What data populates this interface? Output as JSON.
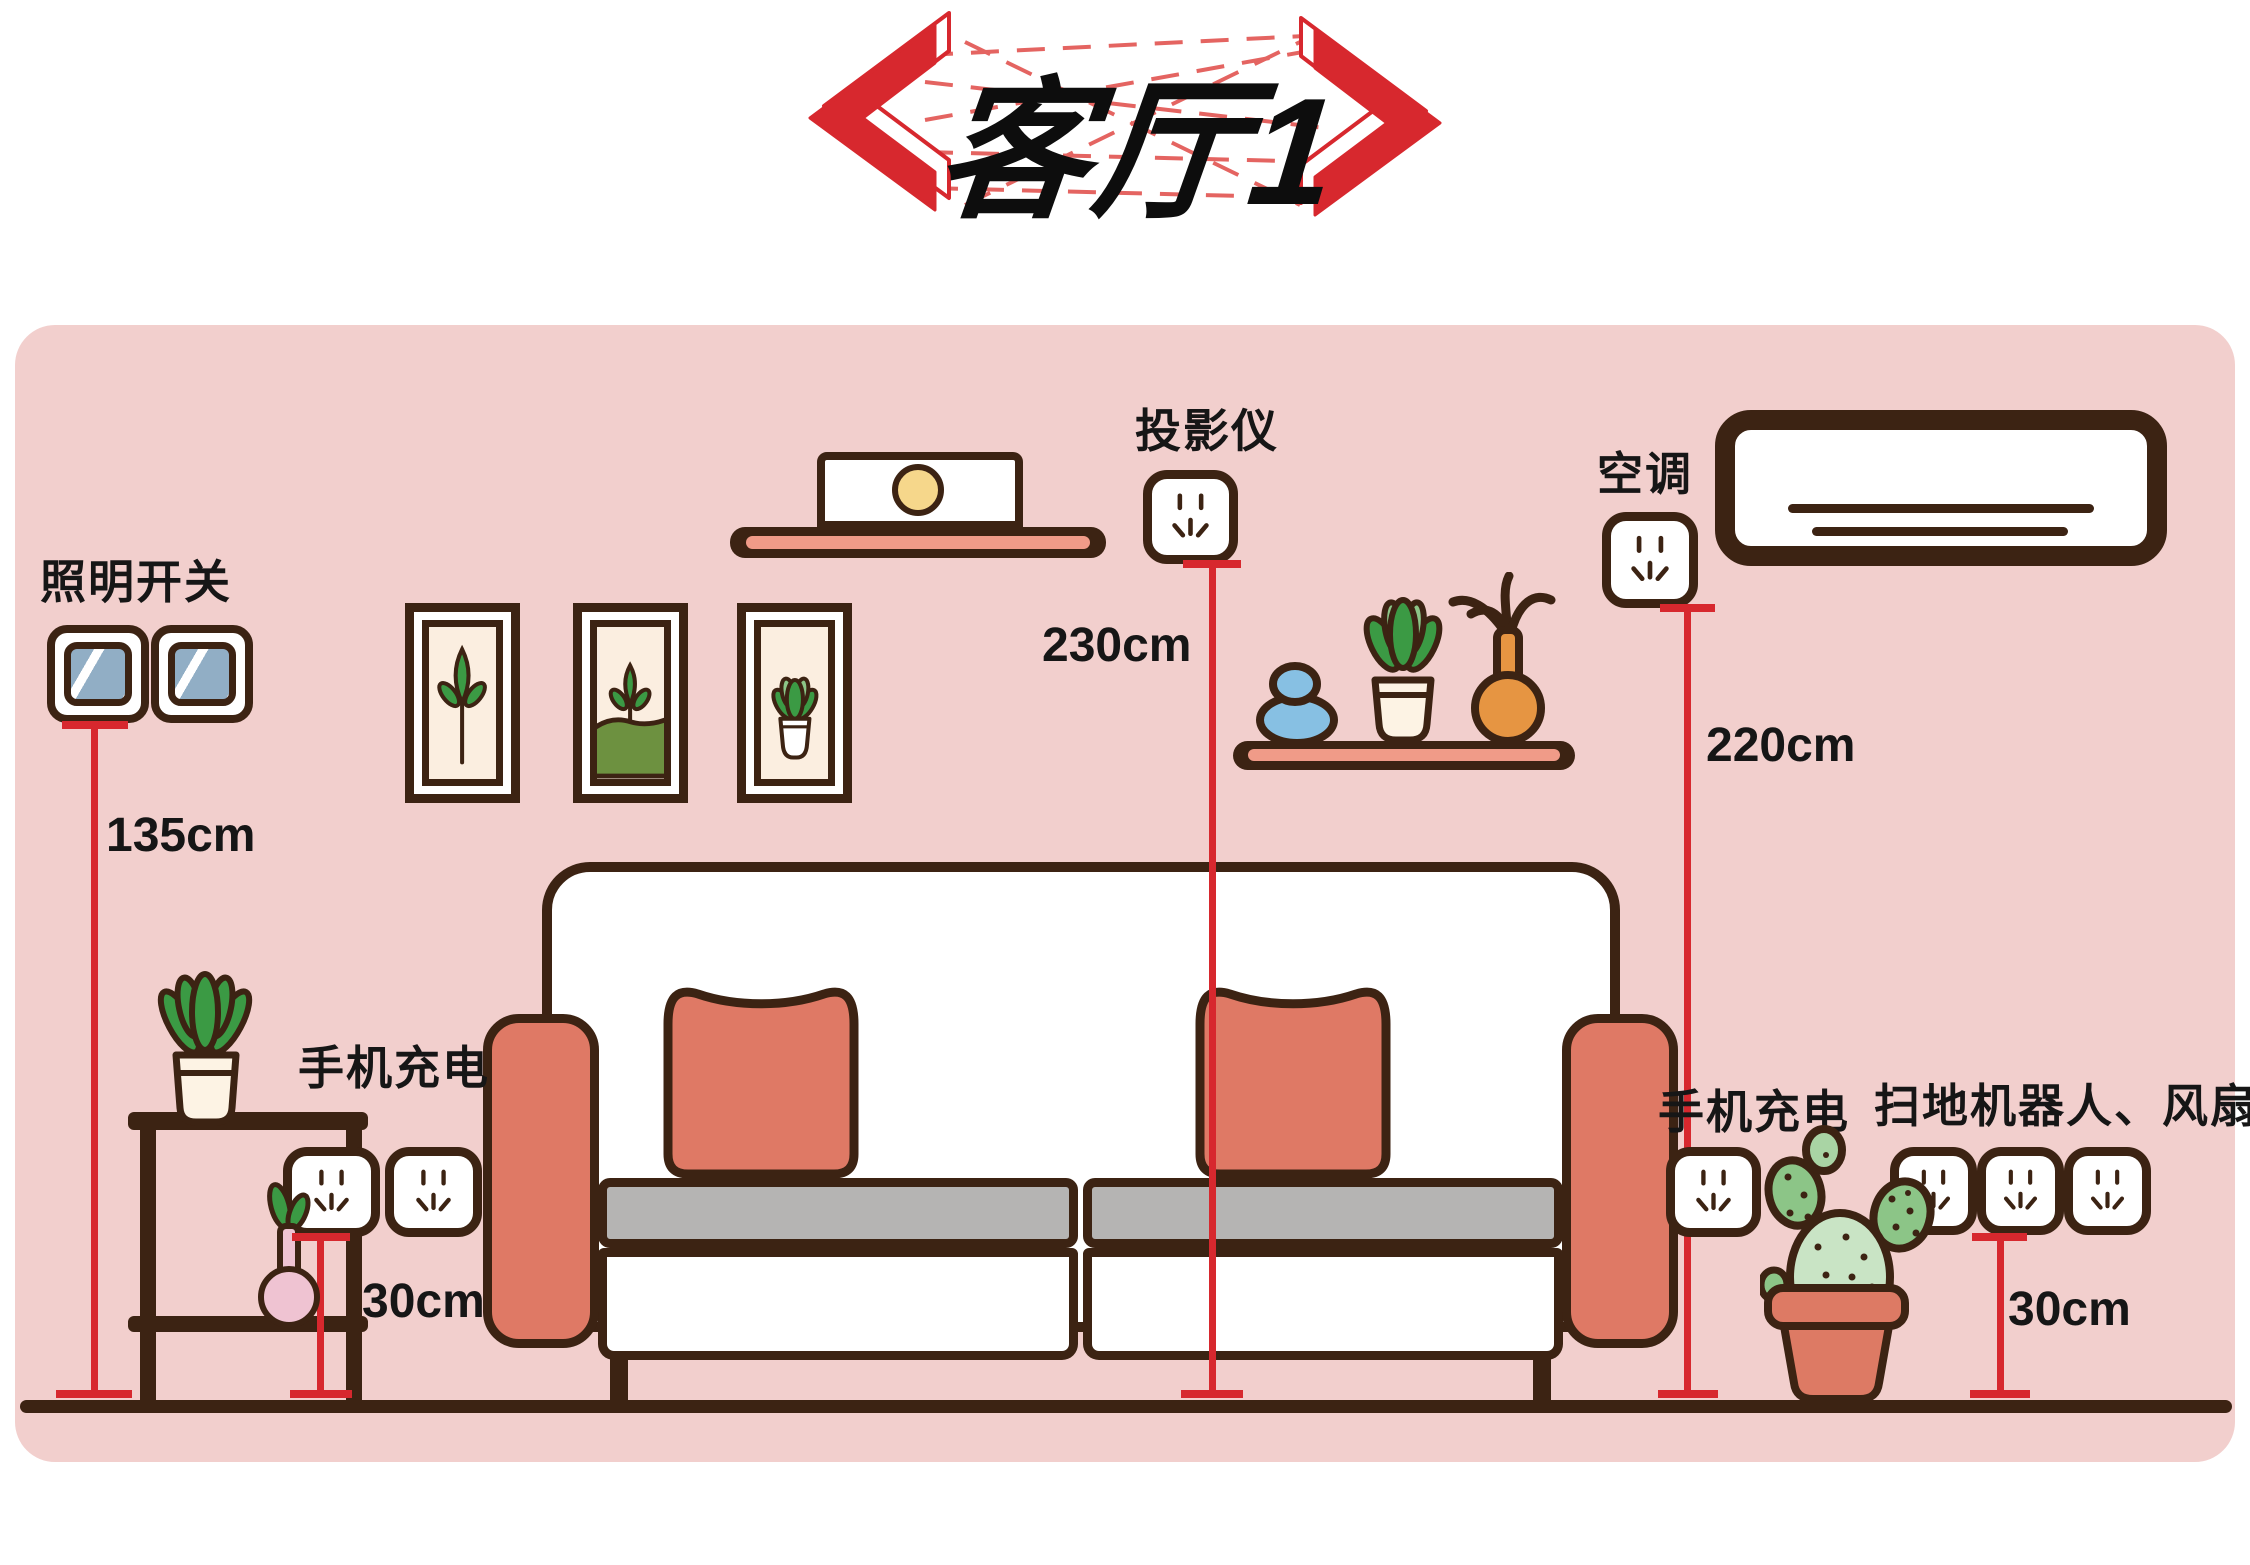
{
  "title": "客厅1",
  "scene": {
    "light_switch": {
      "label": "照明开关",
      "height": "135cm"
    },
    "phone_charge_left": {
      "label": "手机充电",
      "height": "30cm"
    },
    "projector": {
      "label": "投影仪",
      "height": "230cm"
    },
    "air_conditioner": {
      "label": "空调",
      "height": "220cm"
    },
    "phone_charge_right": {
      "label": "手机充电"
    },
    "robot_vacuum_fan": {
      "label": "扫地机器人、风扇",
      "height": "30cm"
    }
  },
  "colors": {
    "wall_pink": "#f2cfcd",
    "outline_brown": "#3c2313",
    "accent_salmon": "#df7965",
    "shelf_stripe": "#f09b88",
    "measure_red": "#d7282e",
    "title_red": "#d7282e",
    "switch_blue": "#91aec5",
    "leaf_green": "#3b9a44",
    "leaf_green_light": "#8cc587",
    "cactus_green": "#c9e4c5",
    "grass_green": "#6d9140",
    "vase_orange": "#e69542",
    "vase_pink": "#efc3d2",
    "stone_blue": "#87c0e3",
    "speaker_yellow": "#f6d78b",
    "seat_gray": "#b5b4b3",
    "cream": "#fbeee0"
  }
}
